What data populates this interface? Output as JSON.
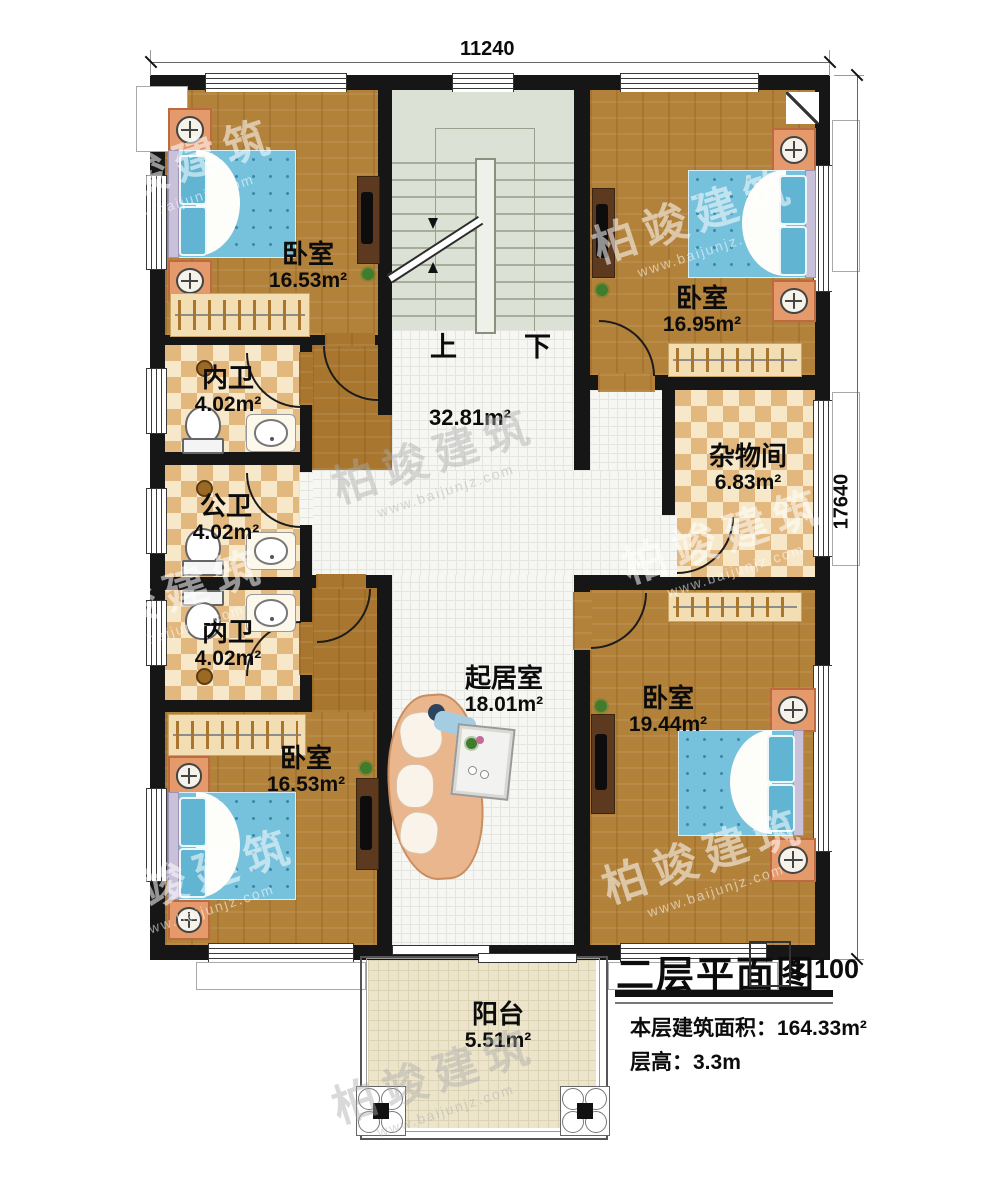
{
  "dimensions": {
    "top": "11240",
    "right": "17640"
  },
  "stairs": {
    "up_label": "上",
    "down_label": "下"
  },
  "rooms": {
    "bedroom_tl": {
      "name": "卧室",
      "area": "16.53m²"
    },
    "bedroom_tr": {
      "name": "卧室",
      "area": "16.95m²"
    },
    "bath_top": {
      "name": "内卫",
      "area": "4.02m²"
    },
    "bath_mid": {
      "name": "公卫",
      "area": "4.02m²"
    },
    "bath_bot": {
      "name": "内卫",
      "area": "4.02m²"
    },
    "storage": {
      "name": "杂物间",
      "area": "6.83m²"
    },
    "hall": {
      "area": "32.81m²"
    },
    "living": {
      "name": "起居室",
      "area": "18.01m²"
    },
    "bedroom_br": {
      "name": "卧室",
      "area": "19.44m²"
    },
    "bedroom_bl": {
      "name": "卧室",
      "area": "16.53m²"
    },
    "balcony": {
      "name": "阳台",
      "area": "5.51m²"
    }
  },
  "title_block": {
    "title": "二层平面图",
    "scale": "1:100",
    "floor_area": "本层建筑面积：164.33m²",
    "floor_height": "层高：3.3m"
  },
  "watermark": {
    "brand": "柏竣建筑",
    "url": "www.baijunjz.com"
  },
  "colors": {
    "wall": "#161616",
    "wood": "#b2813a",
    "tile_check": "#e2b87e",
    "stair": "#dce1d5",
    "mattress": "#76c2dc"
  }
}
